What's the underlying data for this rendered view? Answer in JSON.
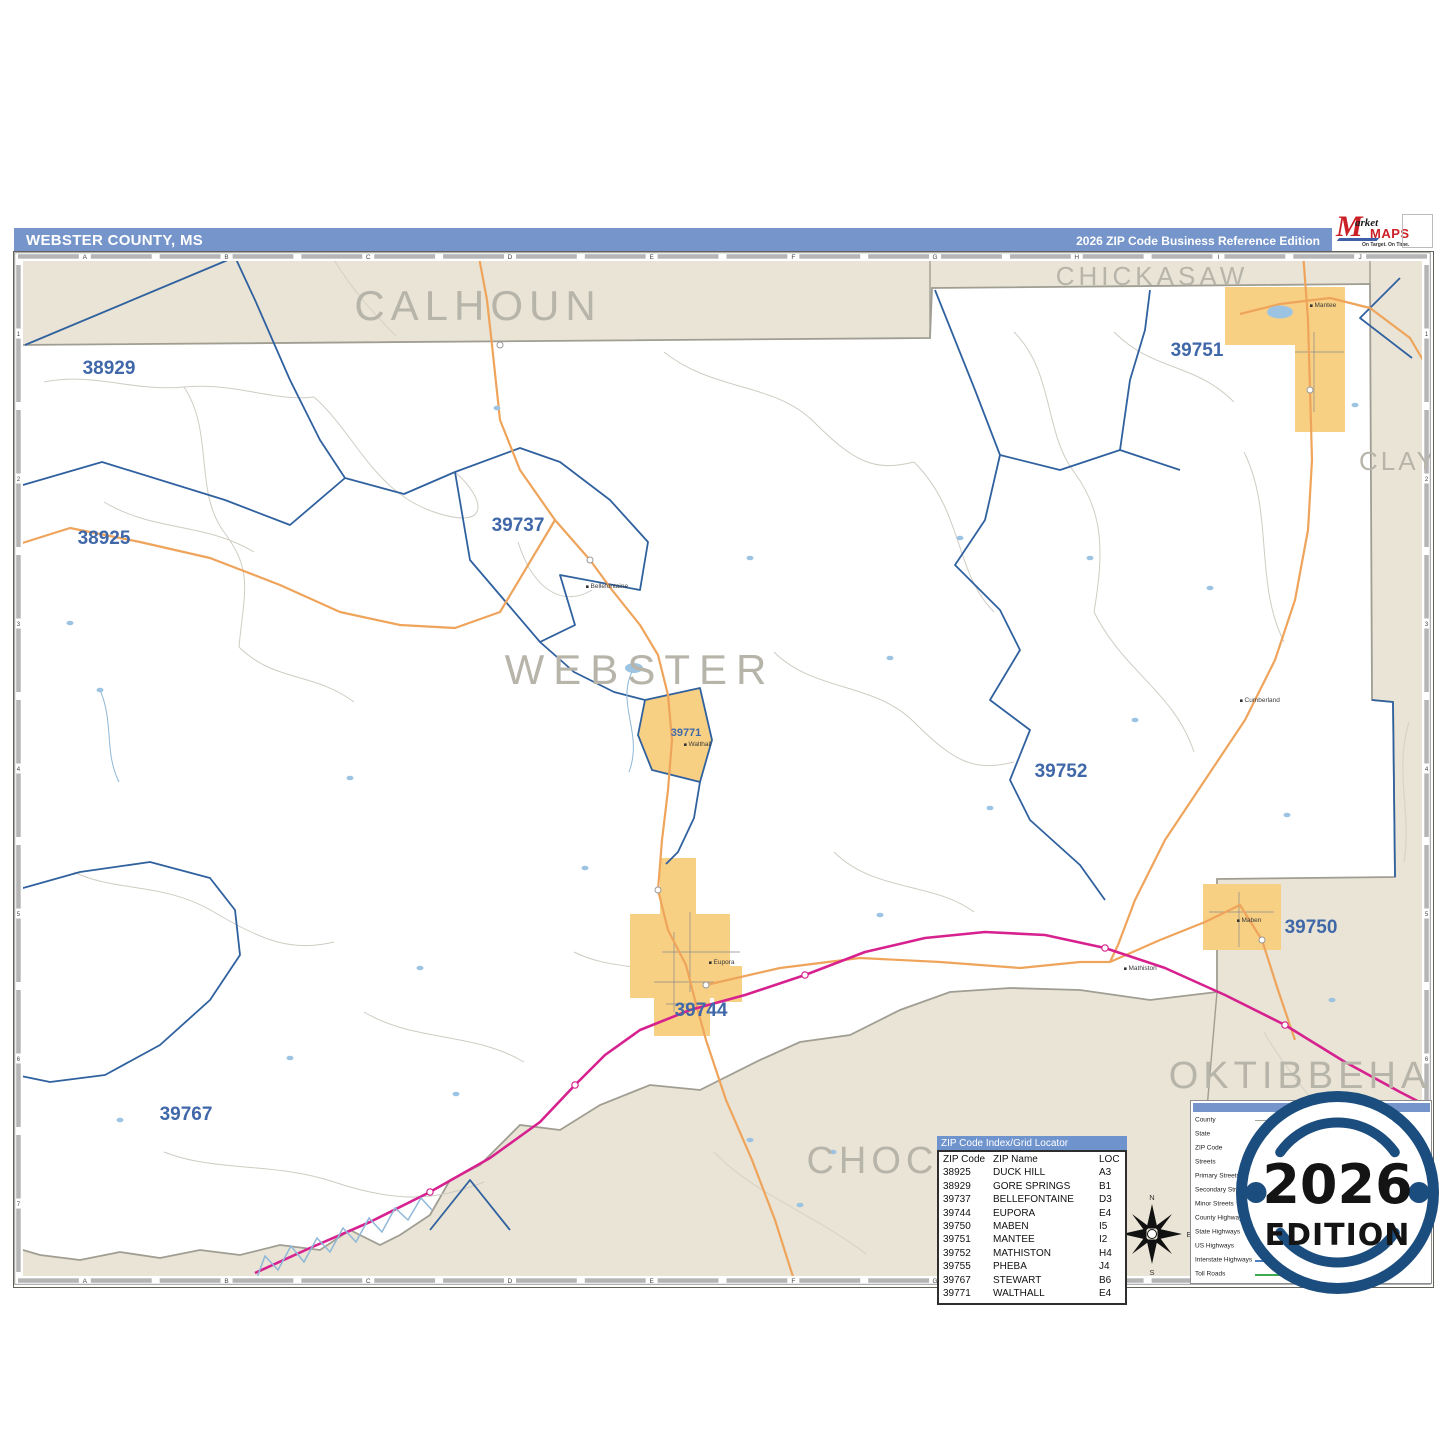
{
  "header": {
    "title": "WEBSTER COUNTY, MS",
    "edition": "2026 ZIP Code Business Reference Edition"
  },
  "logo": {
    "m": "M",
    "market": "arket",
    "maps": "MAPS",
    "tagline": "On Target.  On Time.",
    "subline": "America's Leading Source of Business Maps"
  },
  "grid": {
    "cols": [
      "A",
      "B",
      "C",
      "D",
      "E",
      "F",
      "G",
      "H",
      "I",
      "J"
    ],
    "rows": [
      "1",
      "2",
      "3",
      "4",
      "5",
      "6",
      "7"
    ]
  },
  "map": {
    "county_name_color": "#b7b4aa",
    "zip_label_color": "#4068a8",
    "counties": [
      {
        "text": "CALHOUN",
        "x": 464,
        "y": 68,
        "size": 42,
        "ls": 6
      },
      {
        "text": "CHICKASAW",
        "x": 1138,
        "y": 33,
        "size": 26,
        "ls": 4
      },
      {
        "text": "CLAY",
        "x": 1384,
        "y": 218,
        "size": 26,
        "ls": 3
      },
      {
        "text": "WEBSTER",
        "x": 626,
        "y": 432,
        "size": 42,
        "ls": 9
      },
      {
        "text": "OKTIBBEHA",
        "x": 1286,
        "y": 836,
        "size": 38,
        "ls": 5
      },
      {
        "text": "CHOCTAW",
        "x": 906,
        "y": 921,
        "size": 38,
        "ls": 5
      }
    ],
    "zips": [
      {
        "text": "38929",
        "x": 95,
        "y": 122
      },
      {
        "text": "38925",
        "x": 90,
        "y": 292
      },
      {
        "text": "39737",
        "x": 504,
        "y": 279
      },
      {
        "text": "39751",
        "x": 1183,
        "y": 104
      },
      {
        "text": "39752",
        "x": 1047,
        "y": 525
      },
      {
        "text": "39750",
        "x": 1297,
        "y": 681
      },
      {
        "text": "39744",
        "x": 687,
        "y": 764
      },
      {
        "text": "39767",
        "x": 172,
        "y": 868
      },
      {
        "text": "39771",
        "x": 672,
        "y": 484,
        "size": 11
      }
    ],
    "towns": [
      {
        "name": "Mantee",
        "x": 1302,
        "y": 57
      },
      {
        "name": "Cumberland",
        "x": 1232,
        "y": 452
      },
      {
        "name": "Bellefontaine",
        "x": 578,
        "y": 338
      },
      {
        "name": "Walthall",
        "x": 676,
        "y": 496
      },
      {
        "name": "Eupora",
        "x": 701,
        "y": 714
      },
      {
        "name": "Mathiston",
        "x": 1116,
        "y": 720
      },
      {
        "name": "Maben",
        "x": 1229,
        "y": 672
      }
    ],
    "water": [
      [
        483,
        156
      ],
      [
        56,
        371
      ],
      [
        86,
        438
      ],
      [
        336,
        526
      ],
      [
        571,
        616
      ],
      [
        406,
        716
      ],
      [
        276,
        806
      ],
      [
        106,
        868
      ],
      [
        736,
        306
      ],
      [
        876,
        406
      ],
      [
        946,
        286
      ],
      [
        976,
        556
      ],
      [
        1076,
        306
      ],
      [
        1121,
        468
      ],
      [
        1196,
        336
      ],
      [
        1273,
        563
      ],
      [
        1318,
        748
      ],
      [
        1341,
        153
      ],
      [
        866,
        663
      ],
      [
        736,
        888
      ],
      [
        786,
        953
      ],
      [
        1352,
        904
      ],
      [
        620,
        416,
        18,
        10
      ],
      [
        1266,
        60,
        26,
        13
      ],
      [
        819,
        900
      ],
      [
        442,
        842
      ]
    ]
  },
  "index_table": {
    "title": "ZIP Code Index/Grid Locator",
    "columns": [
      "ZIP Code",
      "ZIP Name",
      "LOC"
    ],
    "rows": [
      [
        "38925",
        "DUCK HILL",
        "A3"
      ],
      [
        "38929",
        "GORE SPRINGS",
        "B1"
      ],
      [
        "39737",
        "BELLEFONTAINE",
        "D3"
      ],
      [
        "39744",
        "EUPORA",
        "E4"
      ],
      [
        "39750",
        "MABEN",
        "I5"
      ],
      [
        "39751",
        "MANTEE",
        "I2"
      ],
      [
        "39752",
        "MATHISTON",
        "H4"
      ],
      [
        "39755",
        "PHEBA",
        "J4"
      ],
      [
        "39767",
        "STEWART",
        "B6"
      ],
      [
        "39771",
        "WALTHALL",
        "E4"
      ]
    ]
  },
  "legend": {
    "items": [
      {
        "label": "County",
        "color": "#a8a49a",
        "w": 1.5
      },
      {
        "label": "State",
        "color": "#6e6e6e",
        "w": 3
      },
      {
        "label": "ZIP Code",
        "color": "#4d7ebf",
        "w": 2
      },
      {
        "label": "Streets",
        "color": "#c4c4c4",
        "w": 1
      },
      {
        "label": "Primary Streets",
        "color": "#8a8a8a",
        "w": 2
      },
      {
        "label": "Secondary Streets",
        "color": "#a8a8a8",
        "w": 1.5
      },
      {
        "label": "Minor Streets",
        "color": "#cccccc",
        "w": 1
      },
      {
        "label": "County Highways",
        "color": "#9a9a9a",
        "w": 1.5
      },
      {
        "label": "State Highways",
        "color": "#efa45b",
        "w": 2
      },
      {
        "label": "US Highways",
        "color": "#d6218f",
        "w": 2.5
      },
      {
        "label": "Interstate Highways",
        "color": "#4d7ebf",
        "w": 2.5,
        "shield": true
      },
      {
        "label": "Toll Roads",
        "color": "#3daa4f",
        "w": 2
      }
    ]
  },
  "badge": {
    "year": "2026",
    "edition": "EDITION"
  },
  "compass": {
    "n": "N",
    "e": "E",
    "s": "S",
    "w": "W"
  },
  "colors": {
    "header_blue": "#7595cb",
    "beige": "#e9e4d5",
    "county_line": "#a09d92",
    "zip_boundary": "#30619f",
    "yellow": "#f7d083",
    "orange": "#efa45b",
    "us_highway": "#d6218f",
    "water": "#9cc4e2",
    "badge_navy": "#1b4d7e"
  }
}
